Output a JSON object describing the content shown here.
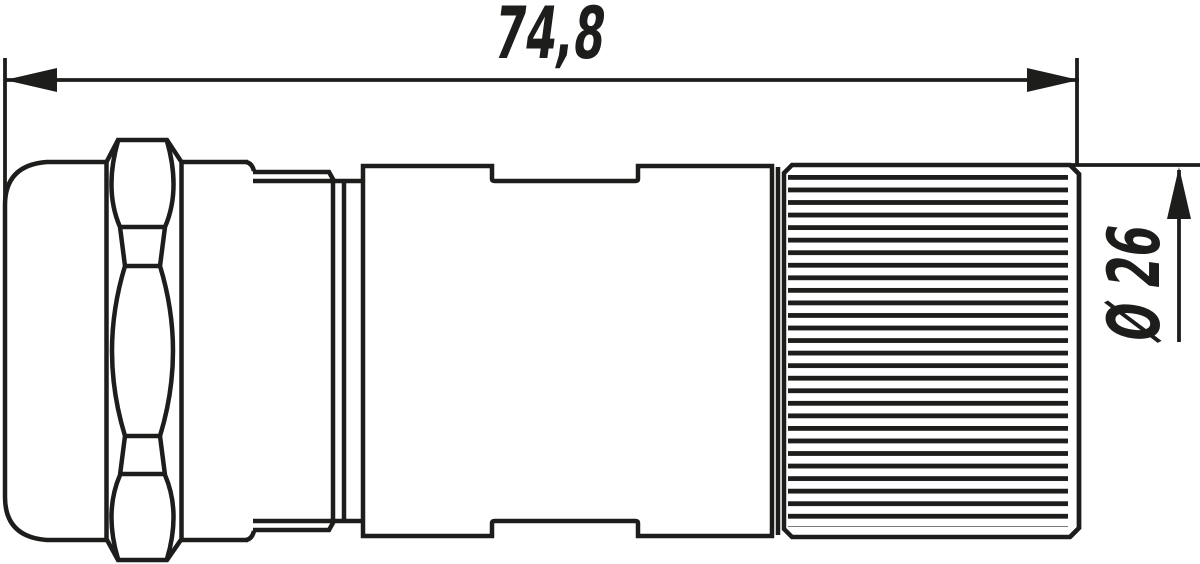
{
  "drawing": {
    "background_color": "#ffffff",
    "line_color": "#1d1d1b",
    "dimensions": {
      "overall_length": {
        "value": "74,8"
      },
      "coupling_diameter": {
        "value": "Ø 26"
      }
    }
  }
}
